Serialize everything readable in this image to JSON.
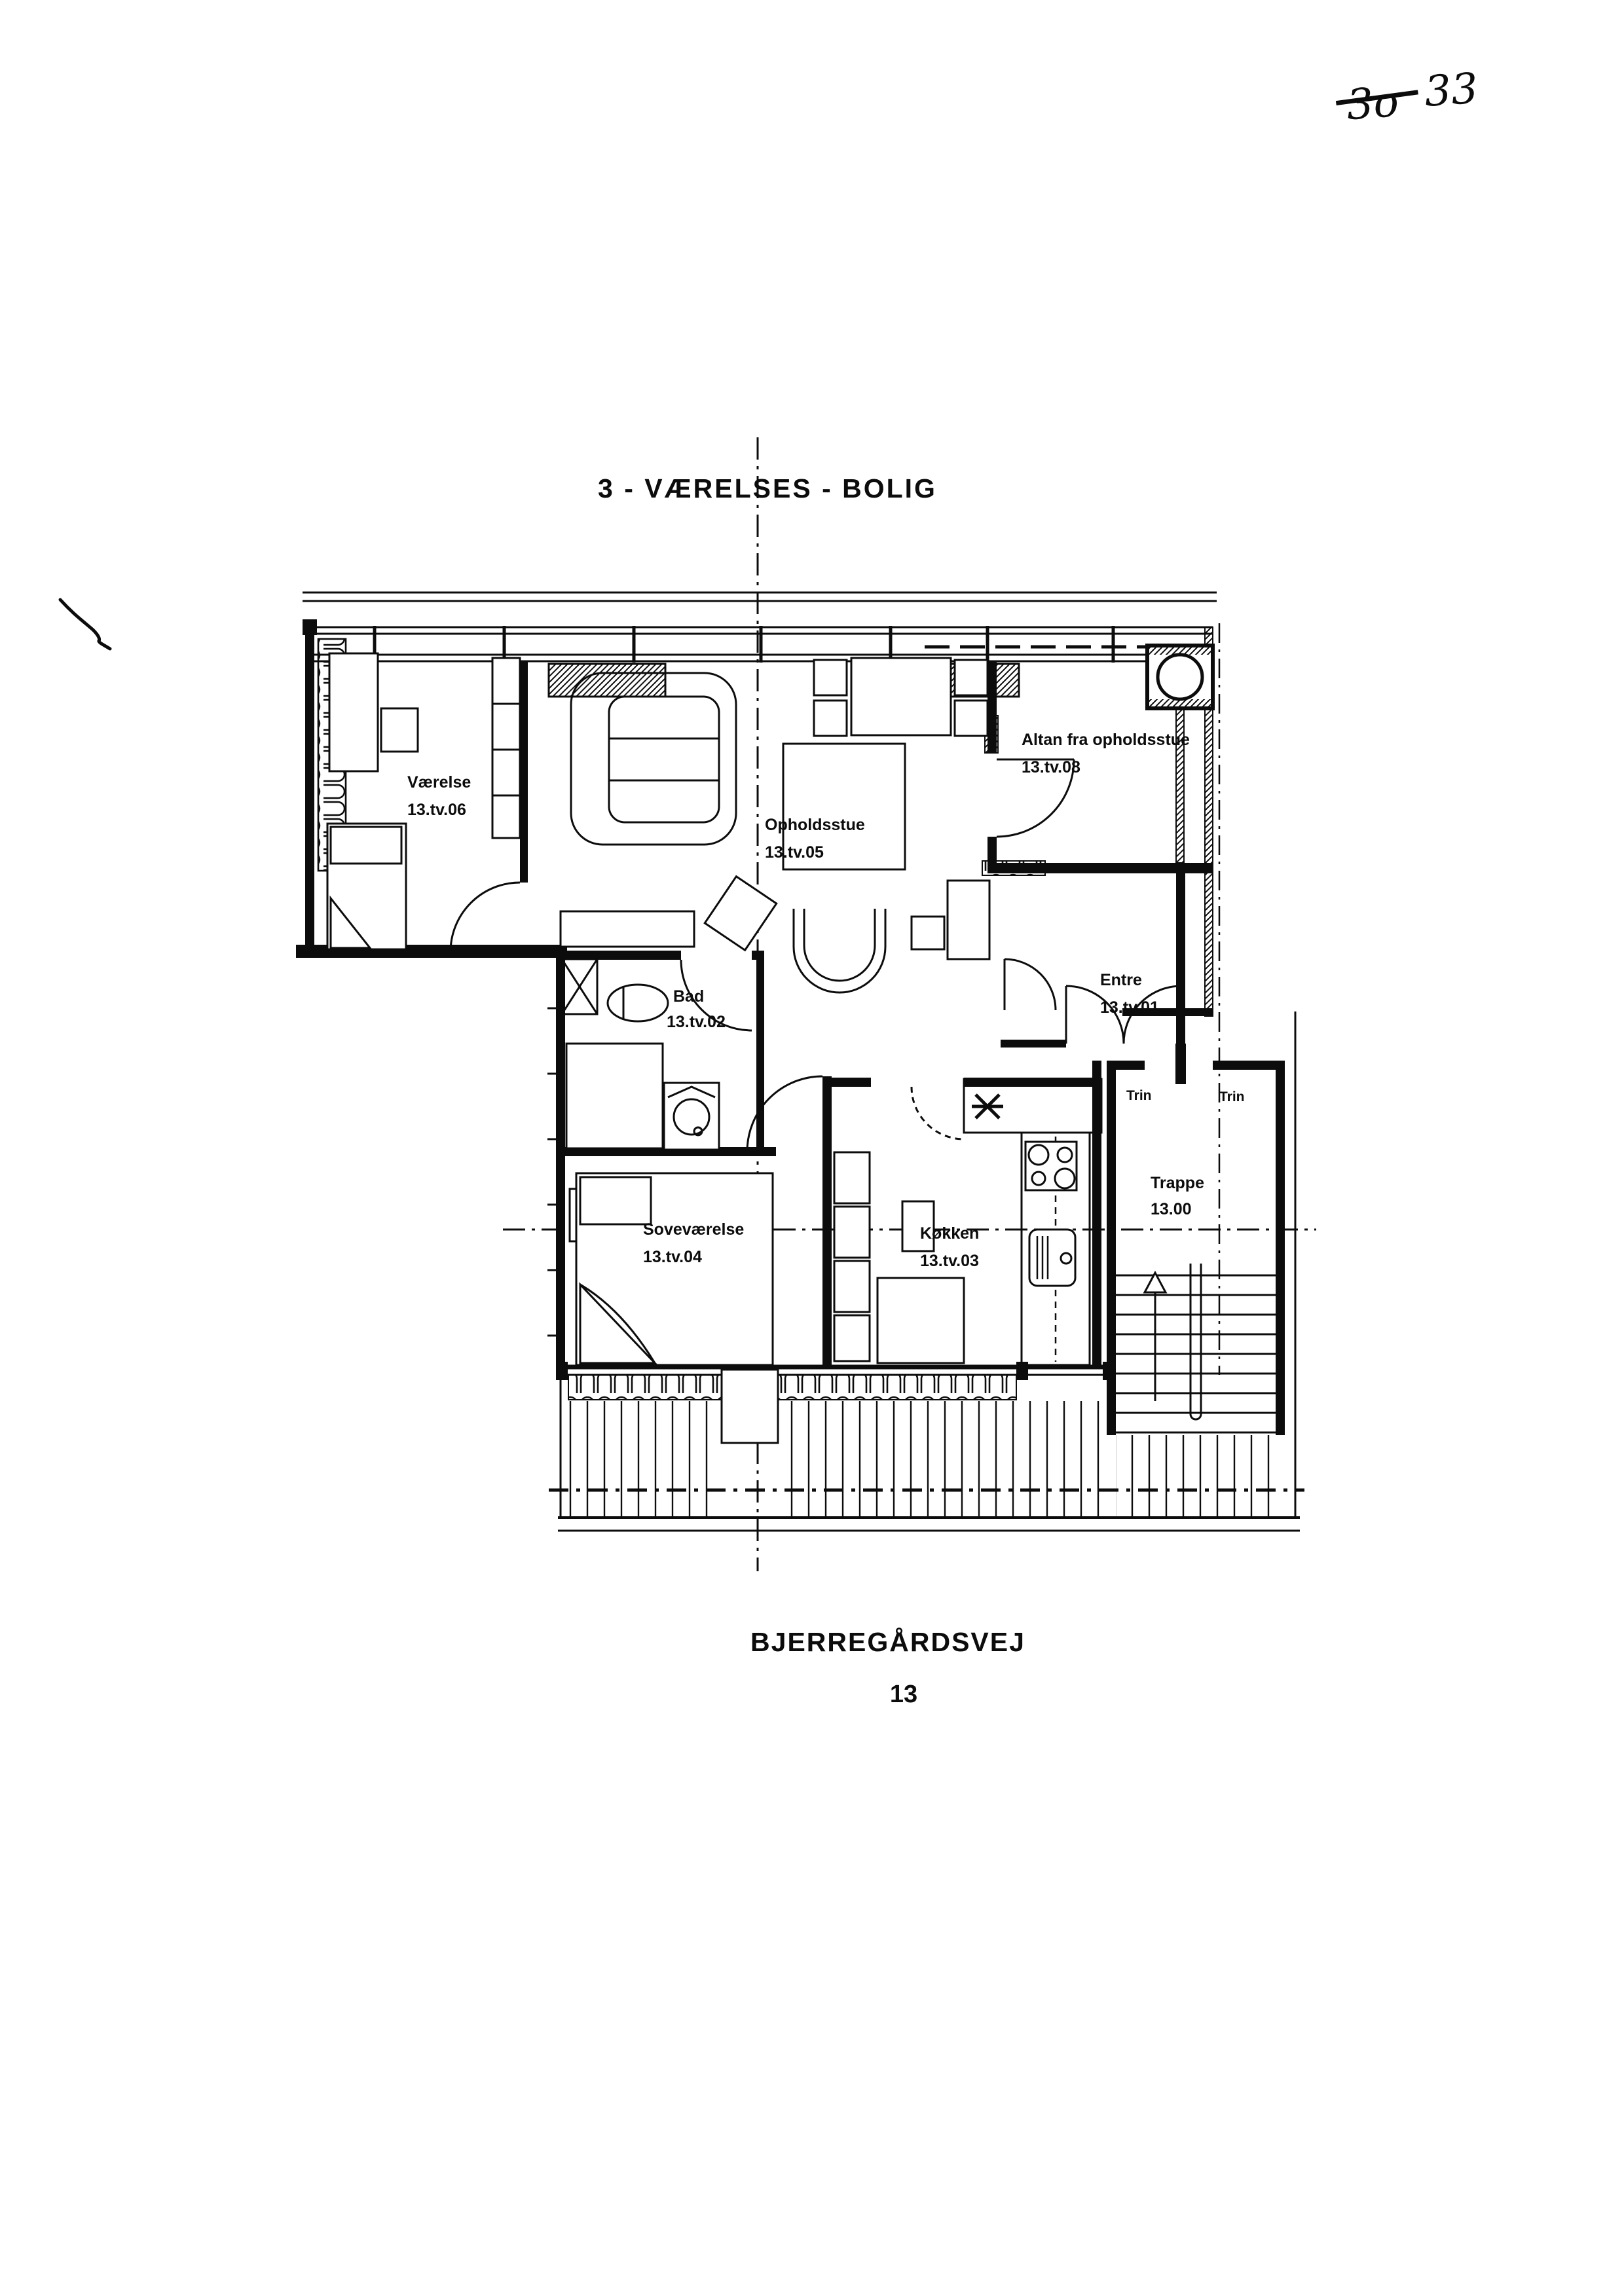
{
  "header": {
    "title": "3 - VÆRELSES - BOLIG"
  },
  "note": {
    "struck": "3o",
    "rest": "33"
  },
  "rooms": [
    {
      "name": "Værelse",
      "id": "13.tv.06"
    },
    {
      "name": "Opholdsstue",
      "id": "13.tv.05"
    },
    {
      "name": "Altan fra opholdsstue",
      "id": "13.tv.08"
    },
    {
      "name": "Entre",
      "id": "13.tv.01"
    },
    {
      "name": "Bad",
      "id": "13.tv.02"
    },
    {
      "name": "Soveværelse",
      "id": "13.tv.04"
    },
    {
      "name": "Køkken",
      "id": "13.tv.03"
    },
    {
      "name": "Trappe",
      "id": "13.00"
    }
  ],
  "stairs": {
    "step_label_left": "Trin",
    "step_label_right": "Trin"
  },
  "footer": {
    "street_name": "BJERREGÅRDSVEJ",
    "street_number": "13"
  },
  "colors": {
    "ink": "#0c0c0c",
    "paper": "#ffffff"
  }
}
